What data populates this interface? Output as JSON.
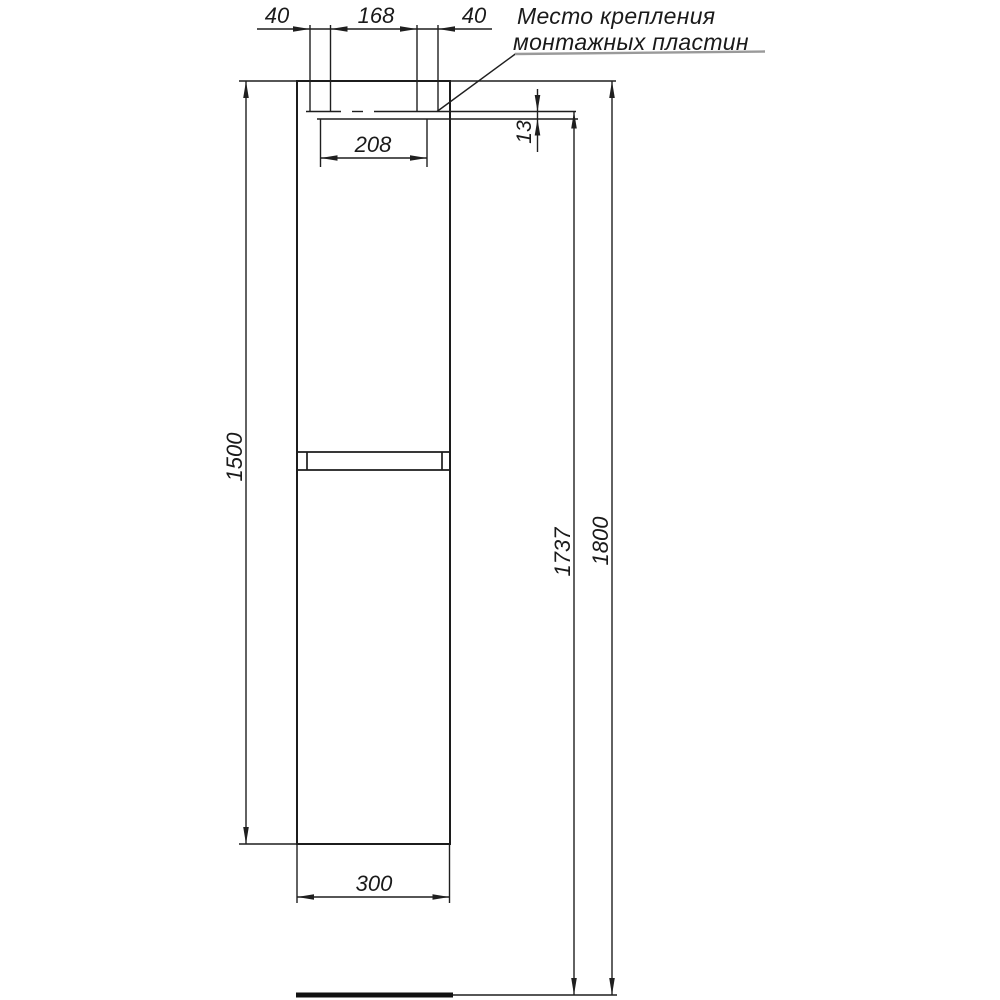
{
  "note": {
    "line1": "Место крепления",
    "line2": "монтажных пластин"
  },
  "dims": {
    "left_plate_offset": "40",
    "plates_gap": "168",
    "right_plate_offset": "40",
    "plate_centers_span": "208",
    "plate_drop": "13",
    "cabinet_height": "1500",
    "mounting_height": "1737",
    "overall_height": "1800",
    "cabinet_width": "300"
  },
  "colors": {
    "line": "#1f1f1f",
    "text": "#1a1a1a",
    "note_underline": "#9a9a9a",
    "background": "#ffffff"
  }
}
